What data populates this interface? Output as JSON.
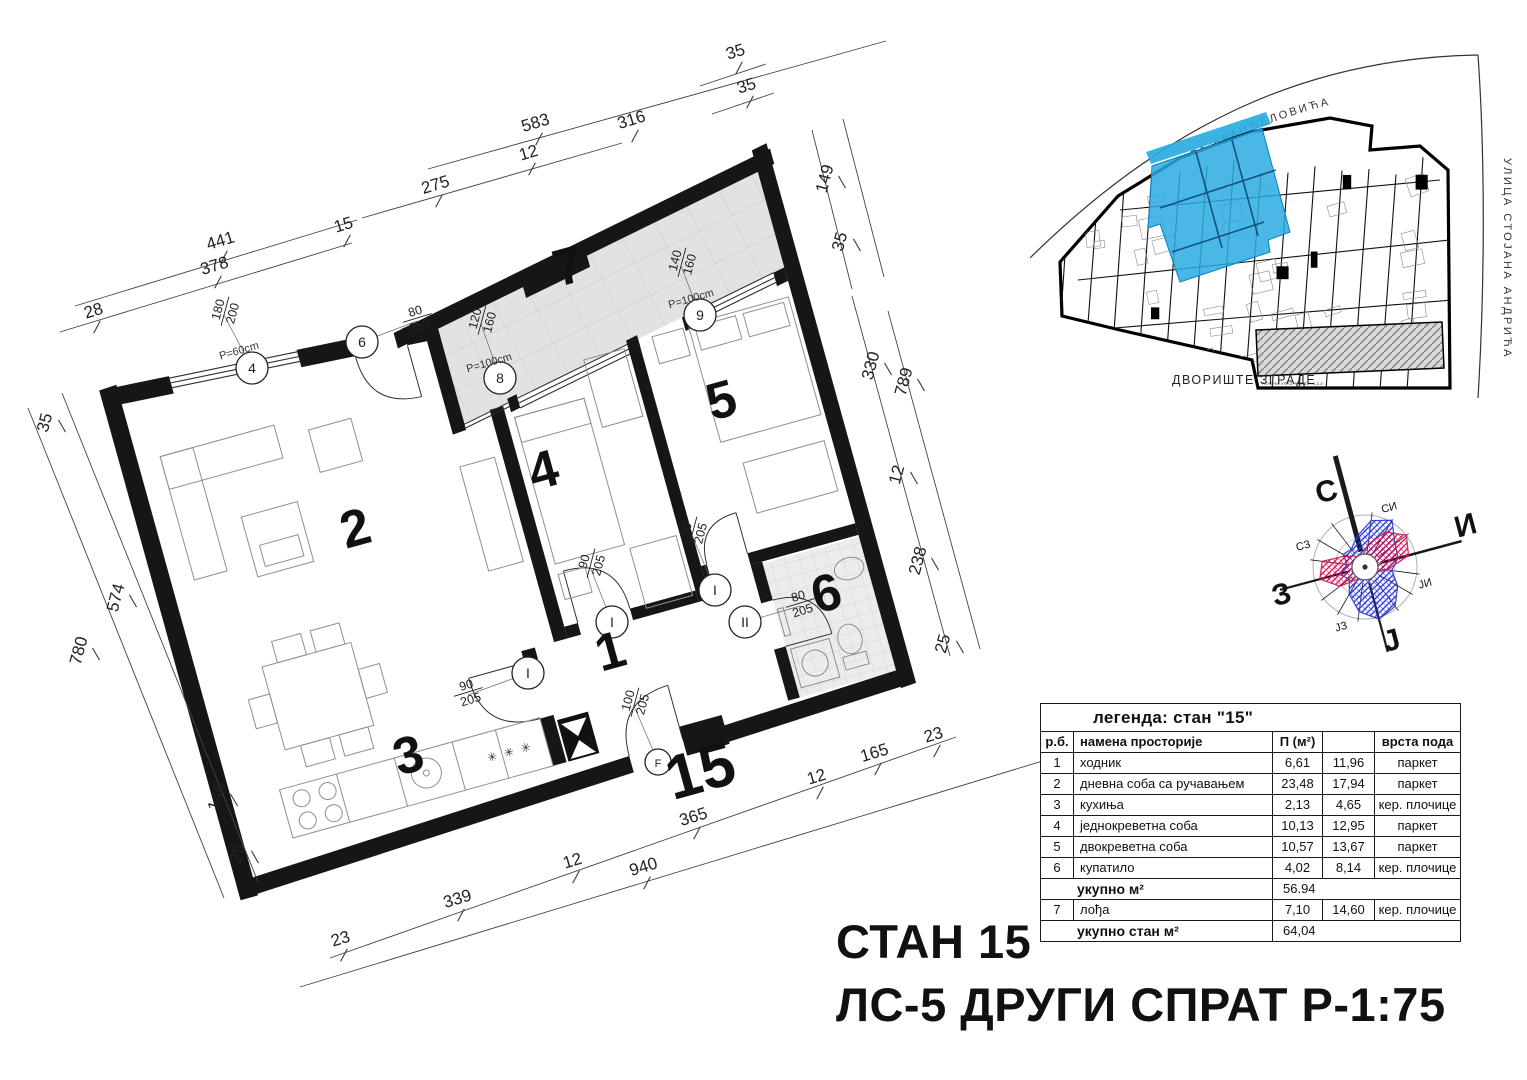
{
  "titles": {
    "line1": "СТАН 15",
    "line2": "ЛС-5 ДРУГИ СПРАТ Р-1:75"
  },
  "site_plan": {
    "street_top": "УЛИЦА ПЕТРА АРАНЂЕЛОВИЋА",
    "street_right": "УЛИЦА СТОЈАНА АНДРИЋА",
    "courtyard_label": "ДВОРИШТЕ ЗГРАДЕ",
    "entrance_note": "ГЛАВНИ УЛАЗ АНЕКСА 1,2,3",
    "highlight_color": "#29abe2"
  },
  "compass": {
    "labels": [
      {
        "t": "С",
        "x": 1329,
        "y": 501,
        "s": 30,
        "b": 1
      },
      {
        "t": "И",
        "x": 1468,
        "y": 535,
        "s": 30,
        "b": 1
      },
      {
        "t": "З",
        "x": 1284,
        "y": 604,
        "s": 30,
        "b": 1
      },
      {
        "t": "Ј",
        "x": 1394,
        "y": 650,
        "s": 30,
        "b": 1
      },
      {
        "t": "СИ",
        "x": 1390,
        "y": 511,
        "s": 11,
        "b": 0
      },
      {
        "t": "ЈИ",
        "x": 1426,
        "y": 587,
        "s": 11,
        "b": 0
      },
      {
        "t": "ЈЗ",
        "x": 1342,
        "y": 630,
        "s": 11,
        "b": 0
      },
      {
        "t": "СЗ",
        "x": 1304,
        "y": 549,
        "s": 11,
        "b": 0
      }
    ],
    "rose": {
      "blue": [
        35,
        52,
        60,
        42,
        38,
        30,
        42,
        55,
        60,
        50,
        35,
        22,
        30,
        20,
        28,
        25
      ],
      "red": [
        12,
        25,
        45,
        58,
        50,
        25,
        12,
        8,
        8,
        10,
        15,
        35,
        52,
        48,
        25,
        15
      ],
      "blue_color": "#2233cc",
      "red_color": "#cc1155"
    }
  },
  "legend": {
    "title": "легенда: стан \"15\"",
    "headers": {
      "no": "р.б.",
      "name": "намена просторије",
      "area": "П (м²)",
      "col4": "",
      "floor": "врста пода"
    },
    "rows": [
      {
        "no": "1",
        "name": "ходник",
        "area": "6,61",
        "val": "11,96",
        "floor": "паркет"
      },
      {
        "no": "2",
        "name": "дневна соба са ручавањем",
        "area": "23,48",
        "val": "17,94",
        "floor": "паркет"
      },
      {
        "no": "3",
        "name": "кухиња",
        "area": "2,13",
        "val": "4,65",
        "floor": "кер. плочице"
      },
      {
        "no": "4",
        "name": "једнокреветна соба",
        "area": "10,13",
        "val": "12,95",
        "floor": "паркет"
      },
      {
        "no": "5",
        "name": "двокреветна соба",
        "area": "10,57",
        "val": "13,67",
        "floor": "паркет"
      },
      {
        "no": "6",
        "name": "купатило",
        "area": "4,02",
        "val": "8,14",
        "floor": "кер. плочице"
      }
    ],
    "subtotal": {
      "label": "укупно м²",
      "value": "56.94"
    },
    "loggia_row": {
      "no": "7",
      "name": "лођа",
      "area": "7,10",
      "val": "14,60",
      "floor": "кер. плочице"
    },
    "total": {
      "label": "укупно стан м²",
      "value": "64,04"
    }
  },
  "plan": {
    "apartment_label": "15",
    "kitchen_marks": "✳ ✳ ✳",
    "room_numbers": [
      {
        "t": "1",
        "x": 615,
        "y": 668,
        "s": 52
      },
      {
        "t": "2",
        "x": 360,
        "y": 545,
        "s": 52
      },
      {
        "t": "3",
        "x": 413,
        "y": 772,
        "s": 52
      },
      {
        "t": "4",
        "x": 548,
        "y": 487,
        "s": 52
      },
      {
        "t": "5",
        "x": 726,
        "y": 417,
        "s": 52
      },
      {
        "t": "6",
        "x": 831,
        "y": 610,
        "s": 52
      },
      {
        "t": "7",
        "x": 573,
        "y": 283,
        "s": 52
      },
      {
        "t": "15",
        "x": 706,
        "y": 791,
        "s": 62
      }
    ],
    "openings": [
      {
        "num": "180",
        "den": "200",
        "x": 224,
        "y": 311,
        "r": -75,
        "circle": {
          "t": "4",
          "cx": 252,
          "cy": 368
        },
        "note": {
          "t": "P=60cm",
          "x": 240,
          "y": 354
        }
      },
      {
        "num": "80",
        "den": "250",
        "x": 417,
        "y": 317,
        "r": -17,
        "circle": {
          "t": "6",
          "cx": 362,
          "cy": 342
        }
      },
      {
        "num": "120",
        "den": "160",
        "x": 481,
        "y": 320,
        "r": -75,
        "circle": {
          "t": "8",
          "cx": 500,
          "cy": 378
        },
        "note": {
          "t": "P=100cm",
          "x": 490,
          "y": 366
        }
      },
      {
        "num": "140",
        "den": "160",
        "x": 681,
        "y": 262,
        "r": -75,
        "circle": {
          "t": "9",
          "cx": 700,
          "cy": 315
        },
        "note": {
          "t": "P=100cm",
          "x": 692,
          "y": 302
        }
      },
      {
        "num": "90",
        "den": "205",
        "x": 590,
        "y": 563,
        "r": -75,
        "circle": {
          "t": "I",
          "cx": 612,
          "cy": 622
        }
      },
      {
        "num": "90",
        "den": "205",
        "x": 692,
        "y": 531,
        "r": -75,
        "circle": {
          "t": "I",
          "cx": 715,
          "cy": 590
        }
      },
      {
        "num": "90",
        "den": "205",
        "x": 468,
        "y": 691,
        "r": -17,
        "circle": {
          "t": "I",
          "cx": 528,
          "cy": 673
        }
      },
      {
        "num": "80",
        "den": "205",
        "x": 800,
        "y": 602,
        "r": -17,
        "circle": {
          "t": "II",
          "cx": 745,
          "cy": 622
        }
      },
      {
        "num": "100",
        "den": "205",
        "x": 634,
        "y": 702,
        "r": -75,
        "circle": {
          "t": "F",
          "cx": 658,
          "cy": 762,
          "small": 1
        }
      }
    ],
    "dimensions": [
      {
        "t": "28",
        "x": 95,
        "y": 316,
        "r": -17
      },
      {
        "t": "441",
        "x": 222,
        "y": 246,
        "r": -17
      },
      {
        "t": "378",
        "x": 216,
        "y": 271,
        "r": -17
      },
      {
        "t": "15",
        "x": 345,
        "y": 230,
        "r": -17
      },
      {
        "t": "275",
        "x": 437,
        "y": 190,
        "r": -17
      },
      {
        "t": "12",
        "x": 530,
        "y": 158,
        "r": -17
      },
      {
        "t": "583",
        "x": 537,
        "y": 128,
        "r": -17
      },
      {
        "t": "316",
        "x": 633,
        "y": 125,
        "r": -17
      },
      {
        "t": "35",
        "x": 737,
        "y": 57,
        "r": -17
      },
      {
        "t": "35",
        "x": 748,
        "y": 91,
        "r": -17
      },
      {
        "t": "149",
        "x": 830,
        "y": 180,
        "r": -75
      },
      {
        "t": "35",
        "x": 845,
        "y": 243,
        "r": -75
      },
      {
        "t": "330",
        "x": 876,
        "y": 367,
        "r": -75
      },
      {
        "t": "789",
        "x": 909,
        "y": 383,
        "r": -75
      },
      {
        "t": "12",
        "x": 902,
        "y": 476,
        "r": -75
      },
      {
        "t": "238",
        "x": 923,
        "y": 562,
        "r": -75
      },
      {
        "t": "25",
        "x": 948,
        "y": 645,
        "r": -75
      },
      {
        "t": "35",
        "x": 50,
        "y": 424,
        "r": -75
      },
      {
        "t": "574",
        "x": 121,
        "y": 599,
        "r": -75
      },
      {
        "t": "780",
        "x": 84,
        "y": 652,
        "r": -75
      },
      {
        "t": "146",
        "x": 222,
        "y": 798,
        "r": -75
      },
      {
        "t": "25",
        "x": 243,
        "y": 855,
        "r": -75
      },
      {
        "t": "23",
        "x": 342,
        "y": 944,
        "r": -17
      },
      {
        "t": "339",
        "x": 459,
        "y": 904,
        "r": -17
      },
      {
        "t": "12",
        "x": 574,
        "y": 866,
        "r": -17
      },
      {
        "t": "940",
        "x": 645,
        "y": 872,
        "r": -17
      },
      {
        "t": "365",
        "x": 695,
        "y": 822,
        "r": -17
      },
      {
        "t": "12",
        "x": 818,
        "y": 782,
        "r": -17
      },
      {
        "t": "165",
        "x": 876,
        "y": 758,
        "r": -17
      },
      {
        "t": "23",
        "x": 935,
        "y": 740,
        "r": -17
      }
    ]
  }
}
